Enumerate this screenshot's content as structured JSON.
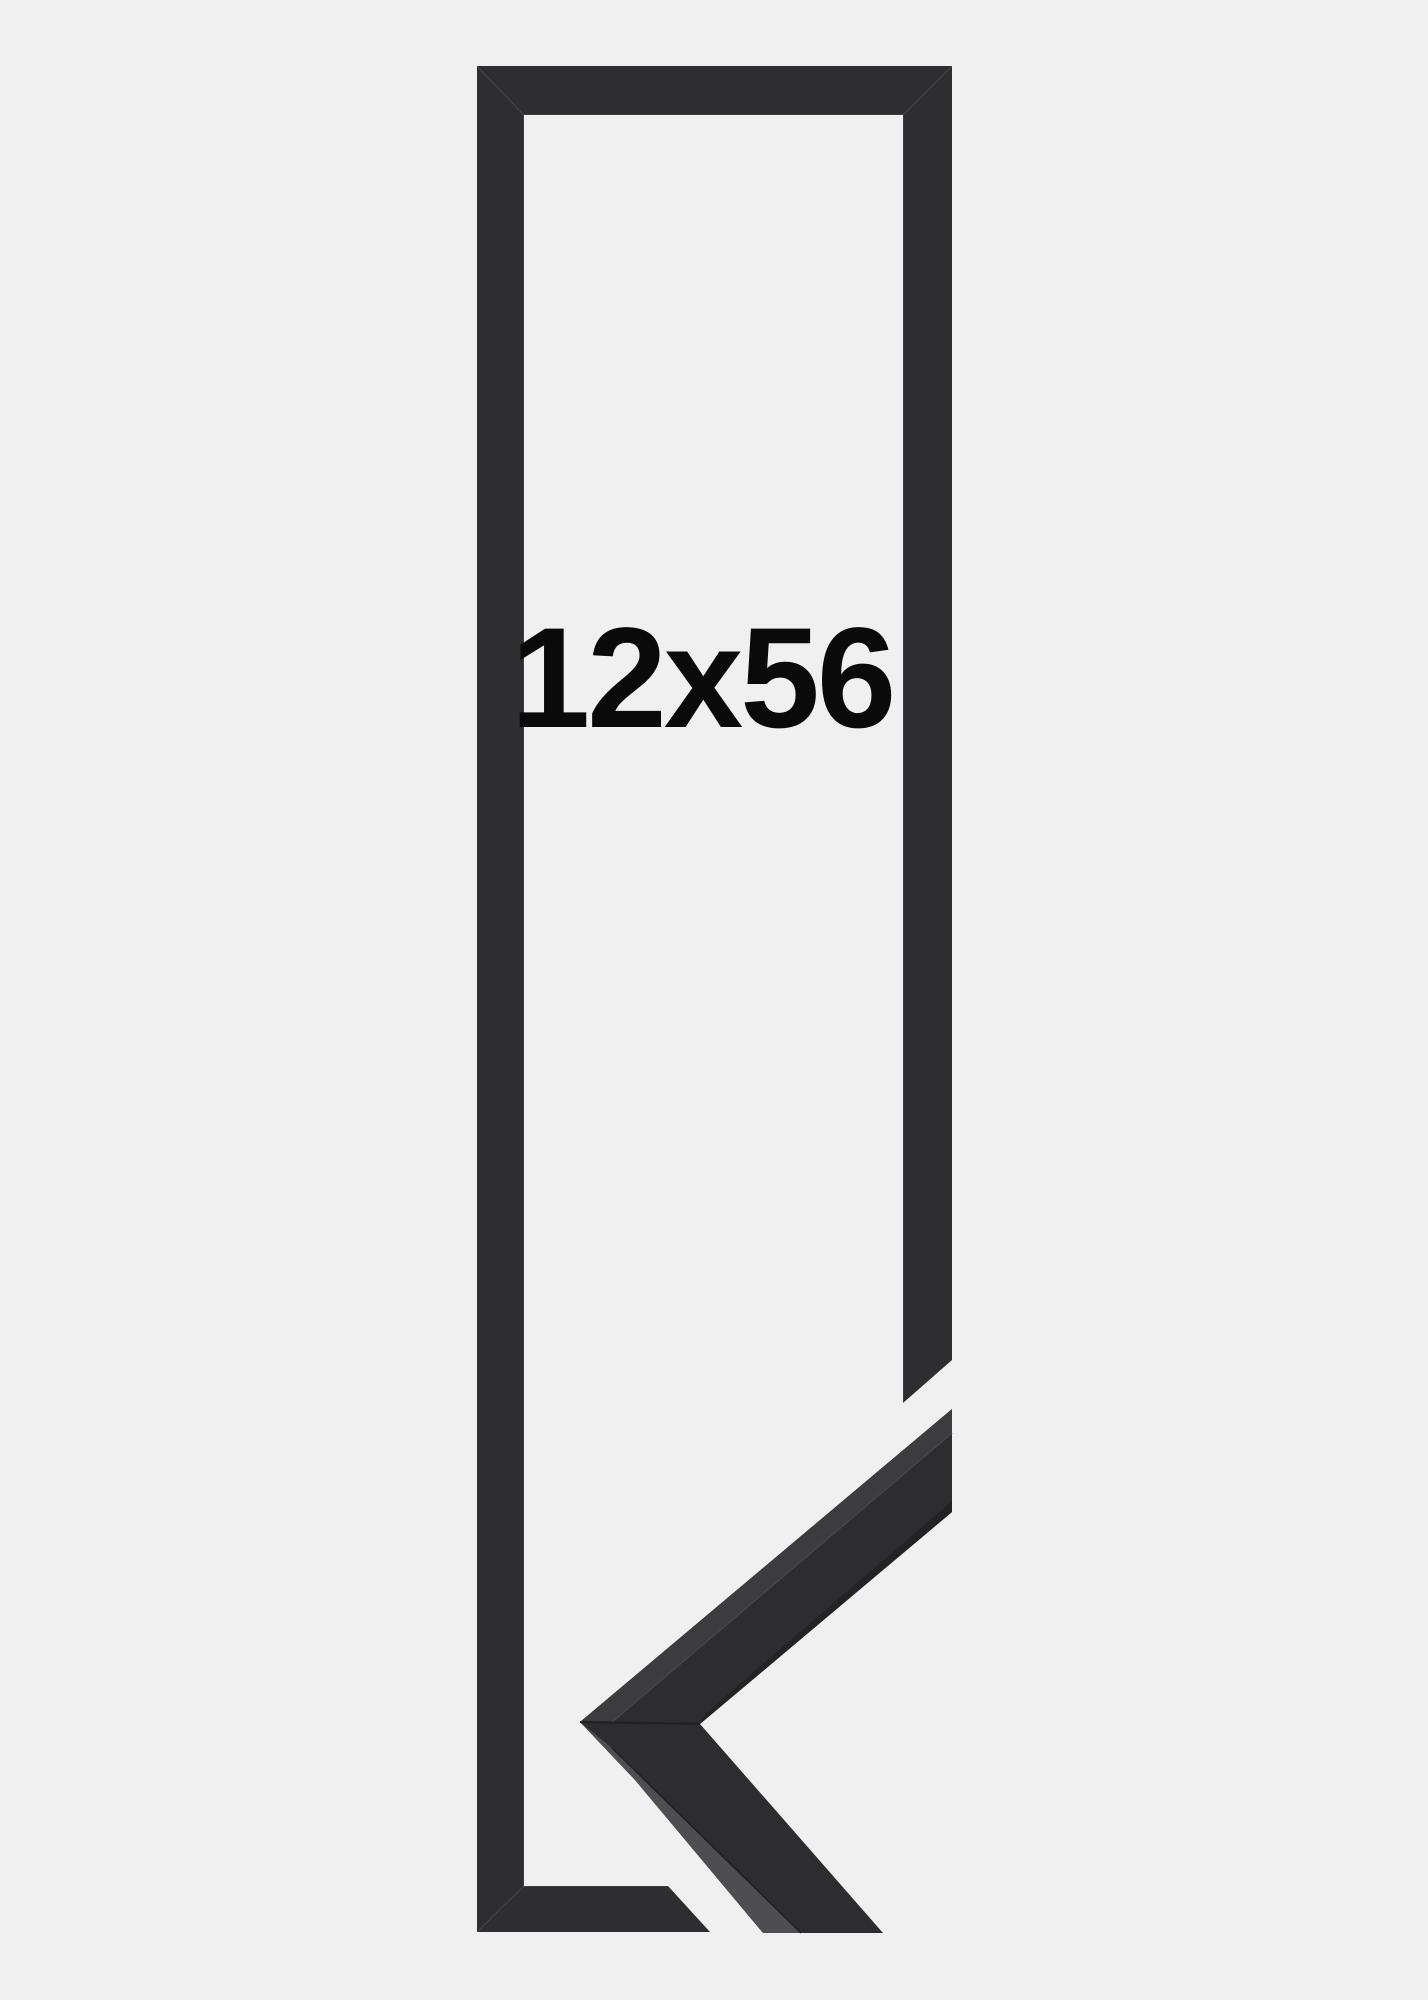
{
  "label": {
    "text": "12x56",
    "color": "#0a0a0a"
  },
  "colors": {
    "background": "#f0f0f1",
    "frame_bar": "#2e2e30",
    "sample_front": "#2d2d2f",
    "sample_top_face": "#3c3c3f",
    "sample_side_face": "#4d4d52",
    "sample_bottom_edge": "#232326",
    "seam_dark": "#202023",
    "arris_highlight": "#45454a"
  }
}
